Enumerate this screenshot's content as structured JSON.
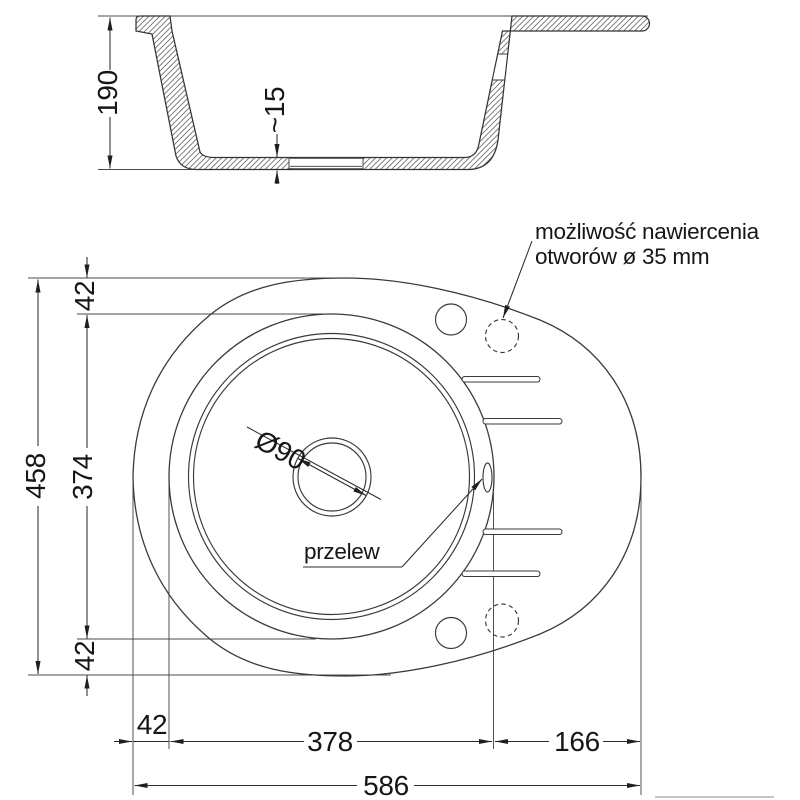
{
  "title": "Granite sink technical dimension drawing",
  "colors": {
    "background": "#ffffff",
    "line": "#3a3a3a",
    "text": "#161616"
  },
  "section_view": {
    "depth_dim": "190",
    "bottom_thickness_dim": "~15"
  },
  "top_view": {
    "total_height_dim": "458",
    "top_margin_dim": "42",
    "bowl_height_dim": "374",
    "bottom_margin_dim": "42",
    "left_margin_dim": "42",
    "bowl_width_dim": "378",
    "drainer_width_dim": "166",
    "total_width_dim": "586",
    "drain_diameter_dim": "Ø90",
    "overflow_label": "przelew",
    "drill_note_line1": "możliwość nawiercenia",
    "drill_note_line2": "otworów ø 35 mm"
  }
}
